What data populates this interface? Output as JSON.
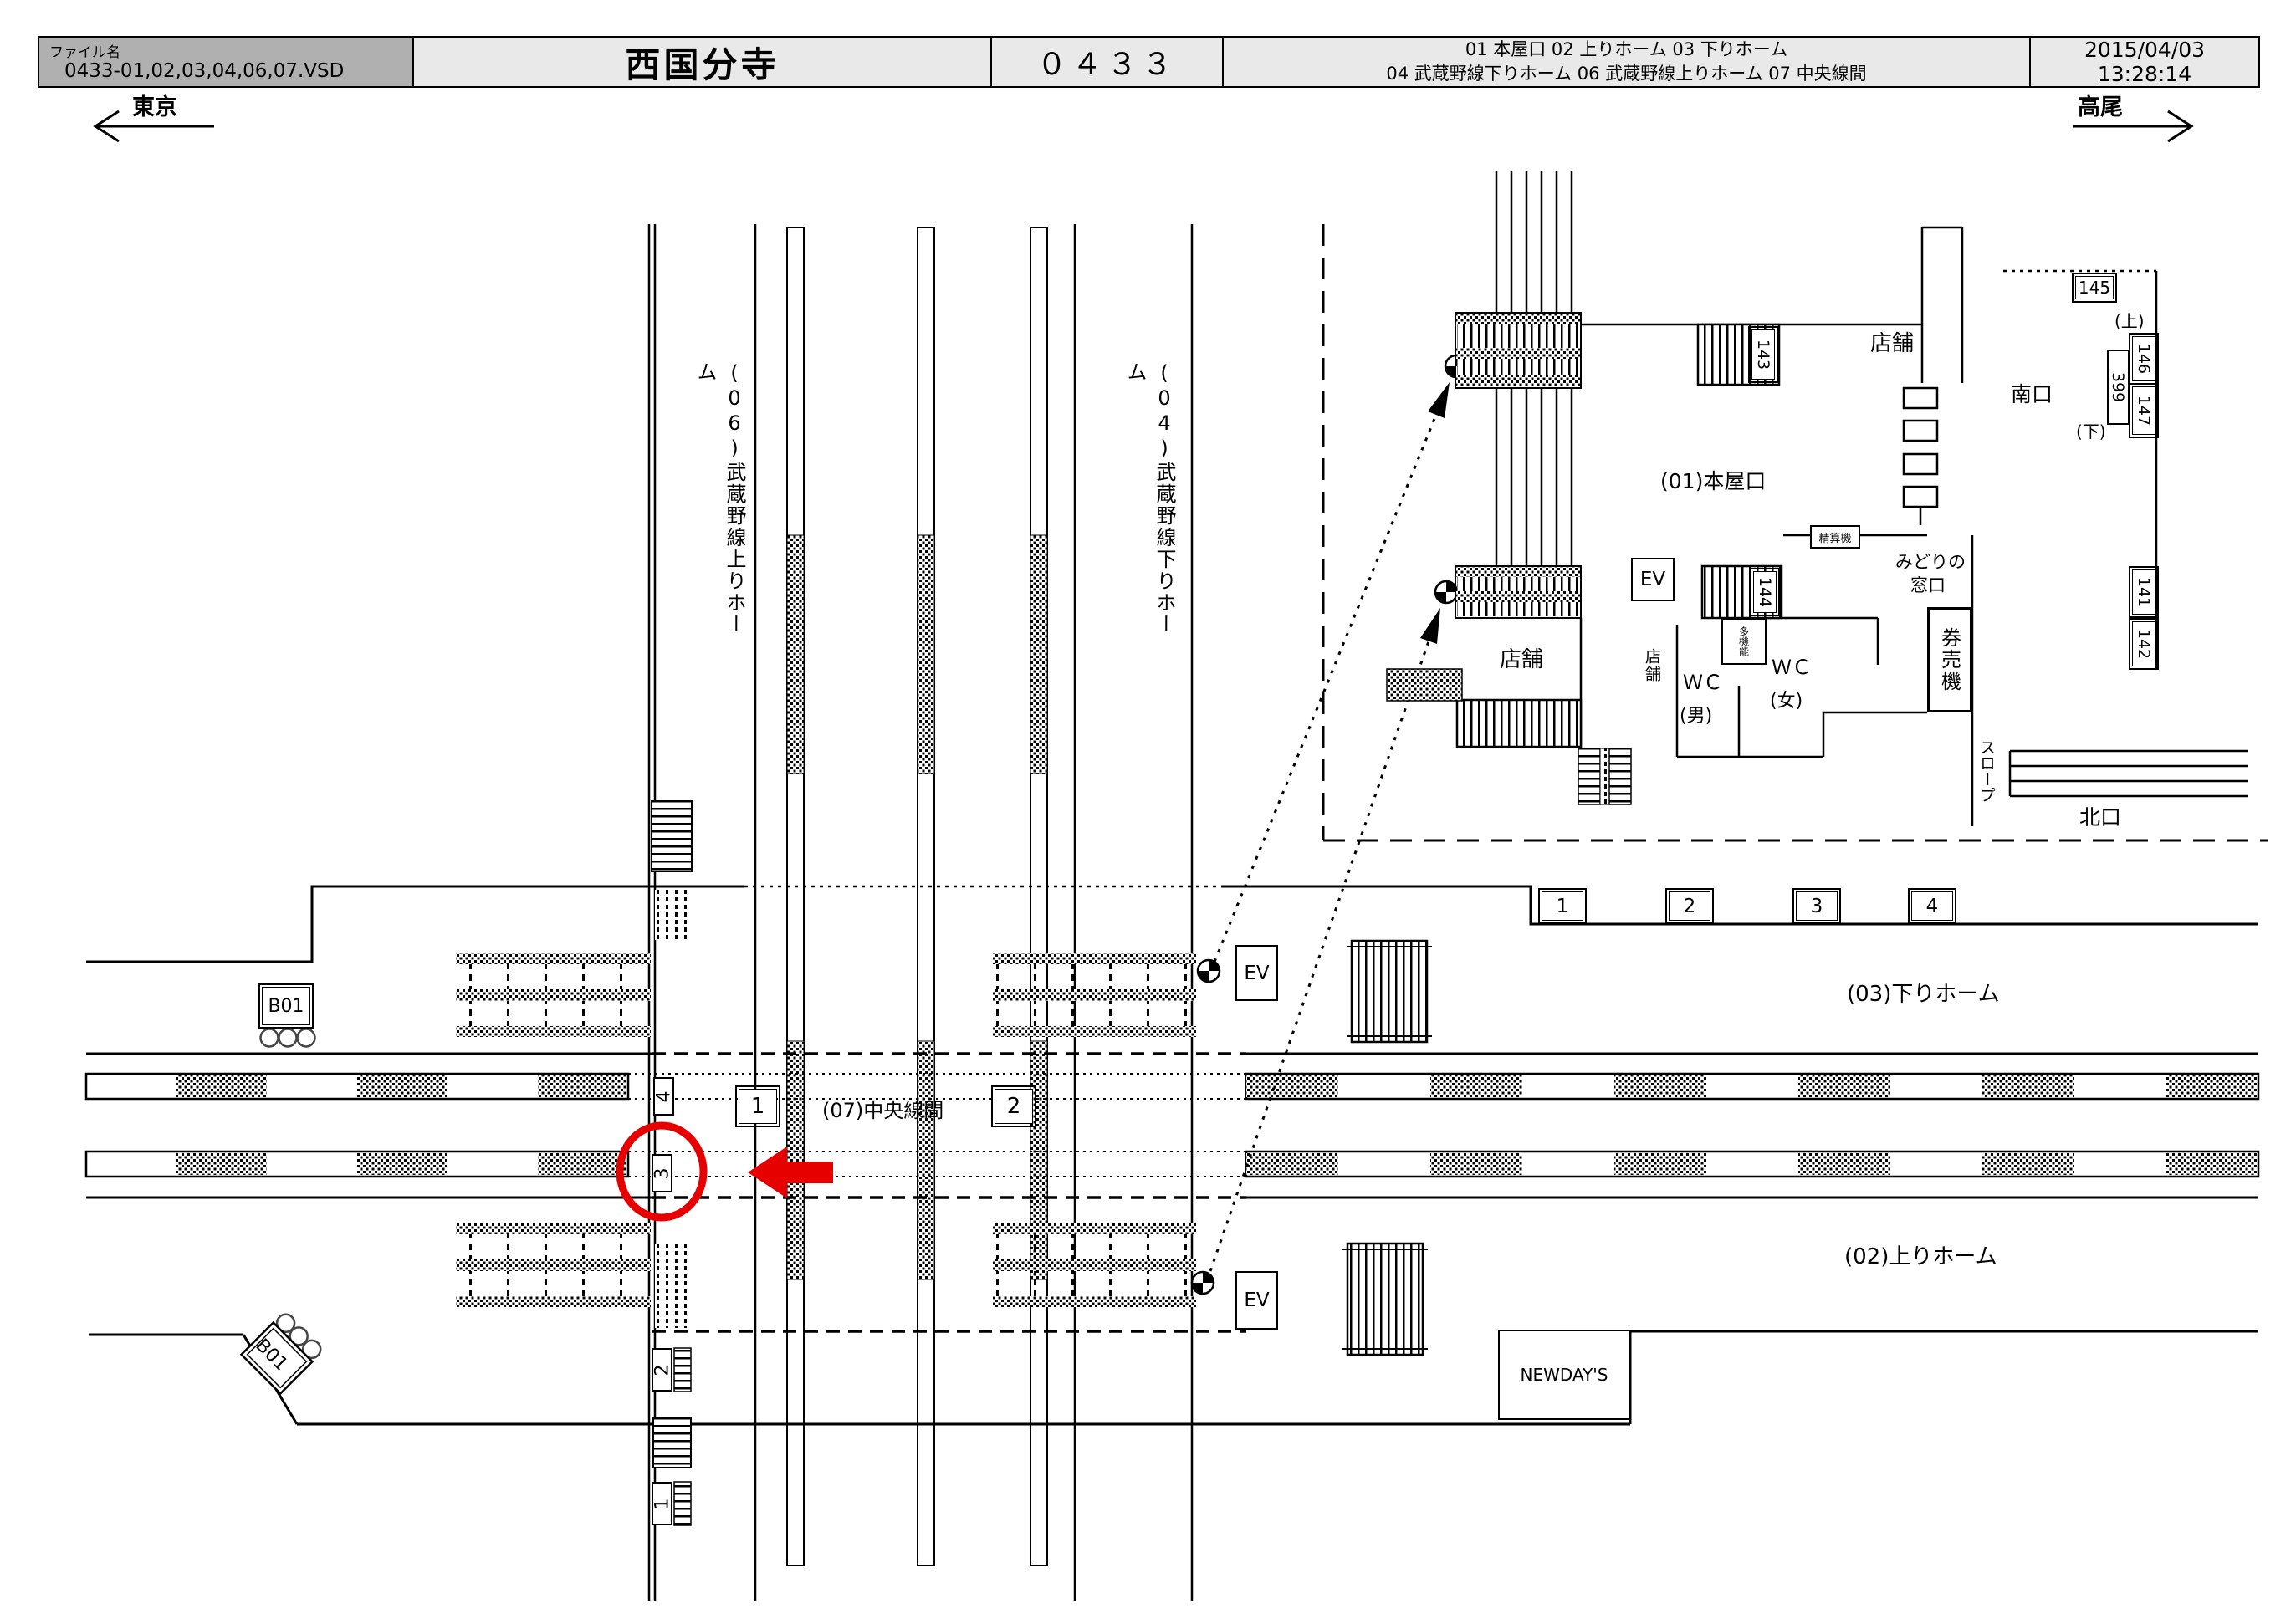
{
  "header": {
    "file_label": "ファイル名",
    "file_value": "0433-01,02,03,04,06,07.VSD",
    "title": "西国分寺",
    "sheet_number": "０４３３",
    "legend_line1": "01 本屋口  02  上りホーム  03  下りホーム",
    "legend_line2": "04  武蔵野線下りホーム  06  武蔵野線上りホーム  07  中央線間",
    "date": "2015/04/03",
    "time": "13:28:14"
  },
  "directions": {
    "left_label": "東京",
    "right_label": "高尾"
  },
  "station_map": {
    "platform_labels": {
      "p06": "(06)武蔵野線上りホーム",
      "p04": "(04)武蔵野線下りホーム",
      "p07": "(07)中央線間",
      "p03": "(03)下りホーム",
      "p02": "(02)上りホーム"
    },
    "sign_b01": "B01",
    "ev_label": "EV",
    "newdays": "NEWDAY'S",
    "door_numbers": [
      "1",
      "2",
      "3",
      "4"
    ],
    "track_labels": {
      "t1": "1",
      "t2": "2"
    },
    "stair_numbers": {
      "s1": "1",
      "s2": "2",
      "s3": "3",
      "s4": "4"
    }
  },
  "inset": {
    "main_entrance": "(01)本屋口",
    "south_exit": "南口",
    "north_exit": "北口",
    "up": "(上)",
    "down": "(下)",
    "midori_line1": "みどりの",
    "midori_line2": "窓口",
    "ticket_machine": "券売機",
    "fare_adjust": "精算機",
    "multi_function": "多機能",
    "wc": "ＷＣ",
    "wc_male": "(男)",
    "wc_female": "(女)",
    "slope": "スロープ",
    "shop": "店舗",
    "ev_label": "EV",
    "pos_141": "141",
    "pos_142": "142",
    "pos_143": "143",
    "pos_144": "144",
    "pos_145": "145",
    "pos_146": "146",
    "pos_147": "147",
    "pos_399": "399"
  },
  "colors": {
    "highlight": "#e60000",
    "header_fill": "#b0b0b0",
    "header_fill_light": "#e9e9e9"
  }
}
